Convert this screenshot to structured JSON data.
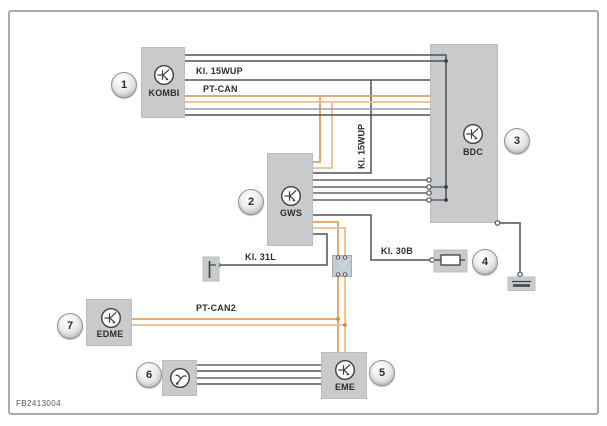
{
  "figure": {
    "code": "FB2413004"
  },
  "components": {
    "kombi": {
      "label": "KOMBI",
      "number": "1"
    },
    "gws": {
      "label": "GWS",
      "number": "2"
    },
    "bdc": {
      "label": "BDC",
      "number": "3"
    },
    "fuse": {
      "number": "4"
    },
    "eme": {
      "label": "EME",
      "number": "5"
    },
    "actuator": {
      "number": "6"
    },
    "edme": {
      "label": "EDME",
      "number": "7"
    }
  },
  "wire_labels": {
    "kl_15wup": "Kl. 15WUP",
    "pt_can": "PT-CAN",
    "kl_15wup_vertical": "Kl. 15WUP",
    "kl_31l": "Kl. 31L",
    "kl_30b": "Kl. 30B",
    "pt_can2": "PT-CAN2"
  },
  "colors": {
    "box_fill": "#c9cacb",
    "wire_dark": "#4d5357",
    "wire_mid": "#5f666b",
    "wire_light": "#97a1a7",
    "can_orange_dark": "#dfa063",
    "can_orange_light": "#ecbf92",
    "splice_cross_blue": "#bcd9e8",
    "frame_border": "#a9adb0"
  }
}
